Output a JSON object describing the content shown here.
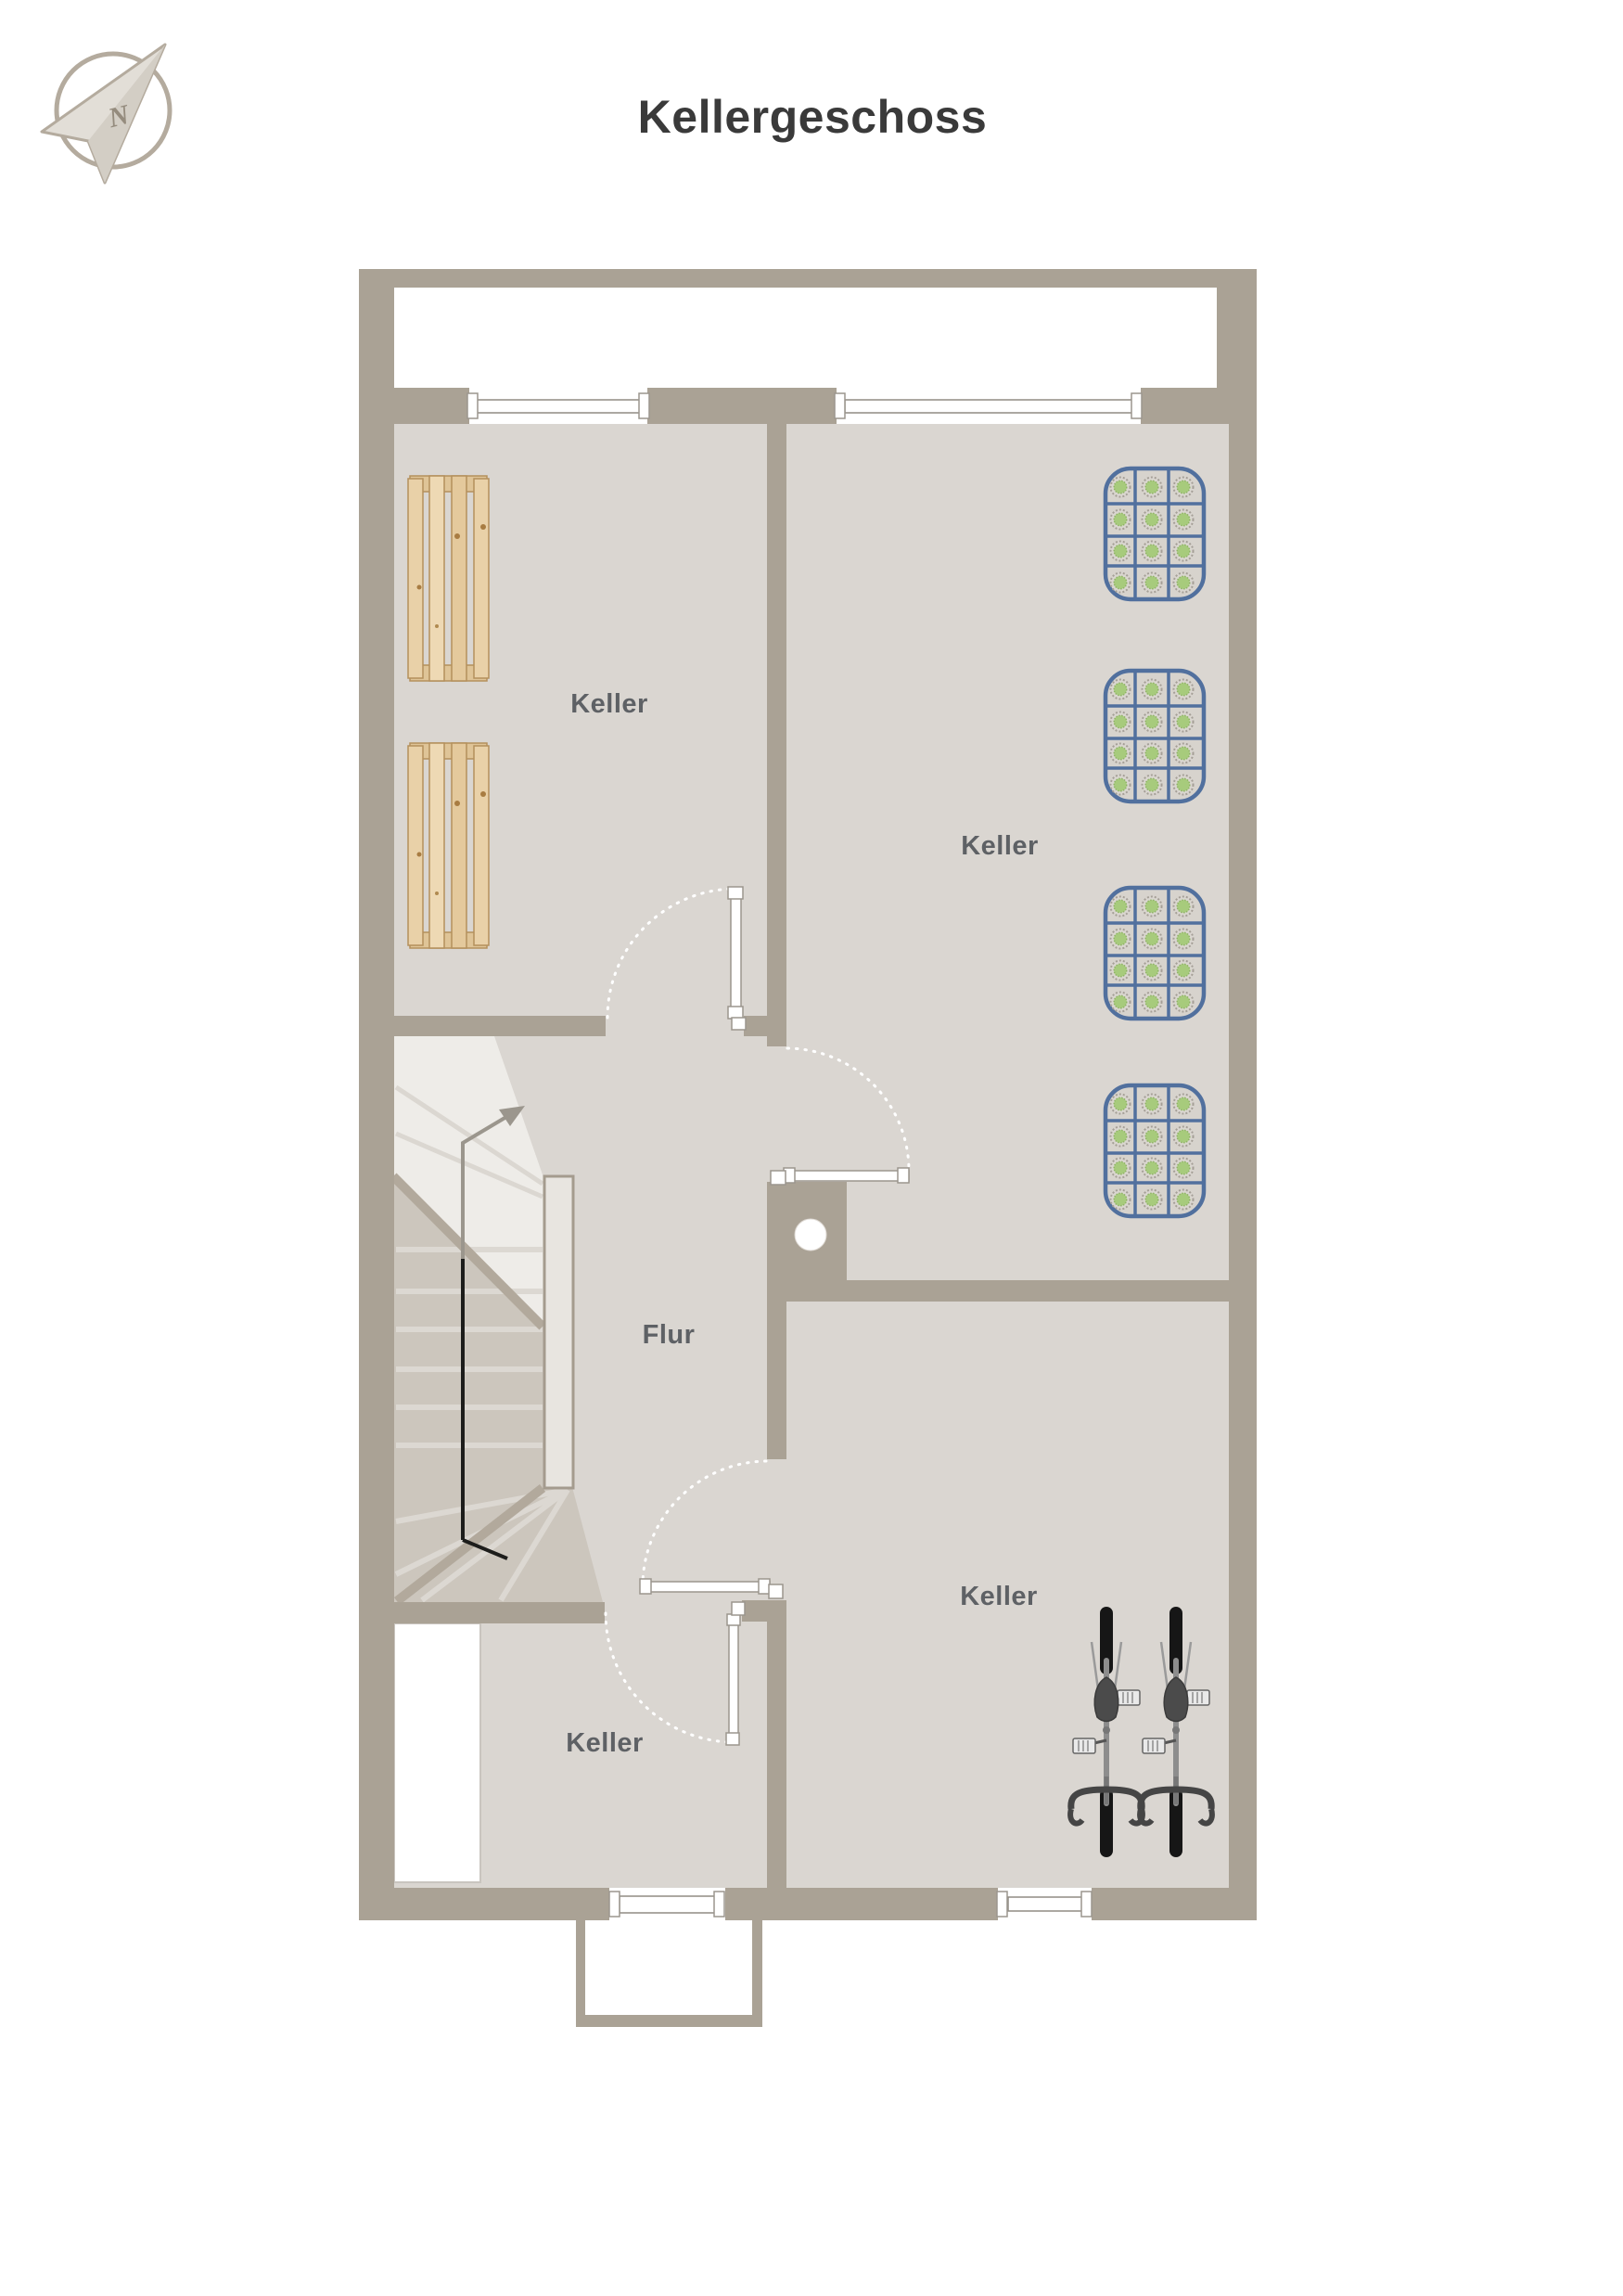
{
  "title": "Kellergeschoss",
  "compass": {
    "letter": "N"
  },
  "rooms": [
    {
      "name": "keller-top-left",
      "label": "Keller"
    },
    {
      "name": "keller-top-right",
      "label": "Keller"
    },
    {
      "name": "flur",
      "label": "Flur"
    },
    {
      "name": "keller-bottom-left",
      "label": "Keller"
    },
    {
      "name": "keller-bottom-right",
      "label": "Keller"
    }
  ],
  "objects": {
    "wooden_pallets": 2,
    "beverage_crates": 4,
    "bicycles": 2,
    "staircase": 1,
    "entrance_porch": 1
  },
  "colors": {
    "wall": "#aaa295",
    "floor": "#dad6d1",
    "stair_light": "#eeece8",
    "stair_dark": "#ccc6bd",
    "crate_blue": "#51709e",
    "crate_green": "#a7cb7c",
    "pallet_wood": "#e7cfa5",
    "room_label": "#5e6165",
    "title": "#3a3a3a"
  }
}
